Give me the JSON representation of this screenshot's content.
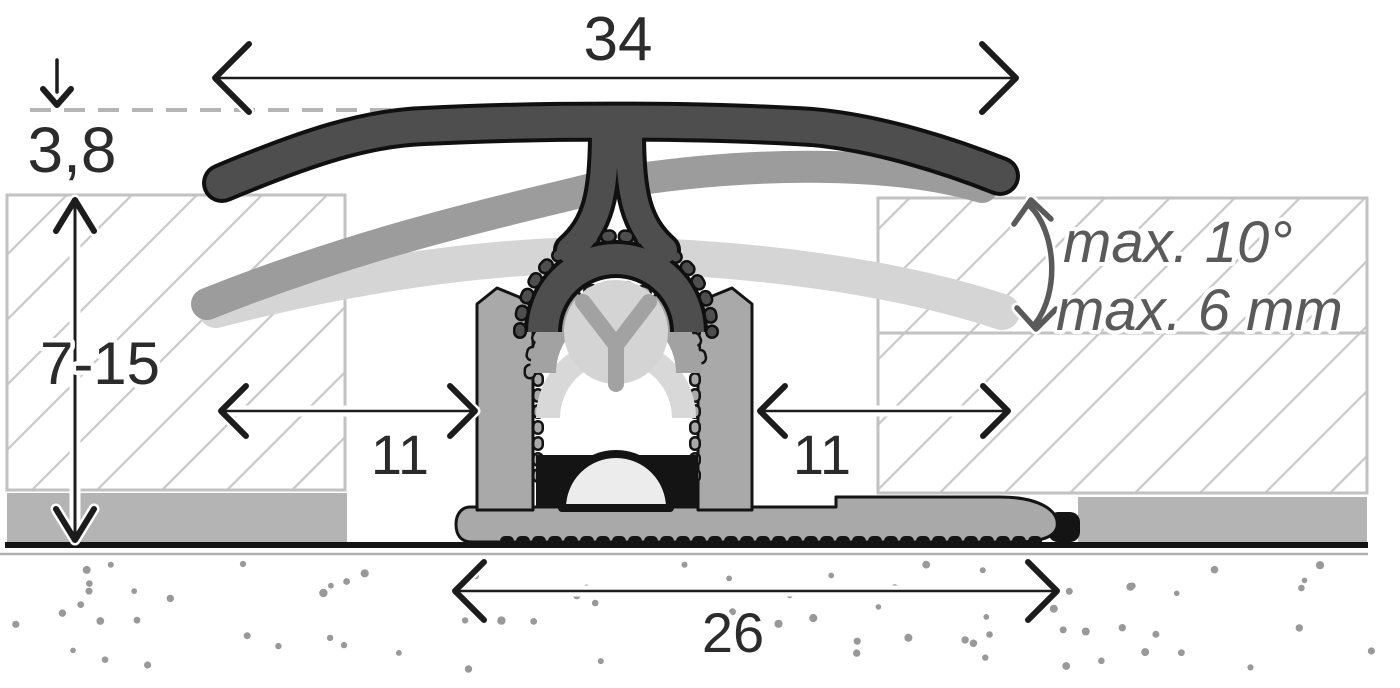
{
  "diagram": {
    "dim_width_total": "34",
    "dim_cover_thickness": "3,8",
    "dim_height_range": "7-15",
    "dim_gap_left": "11",
    "dim_gap_right": "11",
    "dim_base_width": "26",
    "note_max_angle": "max. 10°",
    "note_max_offset": "max. 6 mm",
    "colors": {
      "ink": "#1c1c1c",
      "profile_dark": "#4e4e4e",
      "profile_gray": "#a9a9a9",
      "ghost_medium": "#9c9c9c",
      "ghost_light": "#d5d5d5",
      "hatch_line": "#c9c9c9",
      "hatch_border": "#c2c2c2",
      "underlay": "#b4b4b4",
      "stipple": "#999999",
      "annotation": "#5a5a5a"
    }
  }
}
